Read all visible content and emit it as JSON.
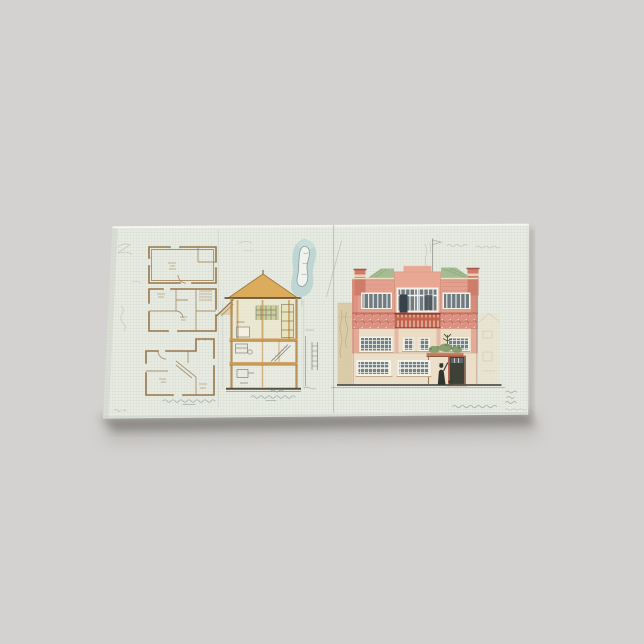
{
  "product": {
    "kind": "stretched canvas print",
    "orientation": "landscape"
  },
  "artwork": {
    "medium": "hand-drawn architectural sheet",
    "panels": [
      {
        "name": "floor-plans",
        "drawings": 3
      },
      {
        "name": "cross-section",
        "drawings": 1
      },
      {
        "name": "front-elevation",
        "drawings": 1
      }
    ],
    "details": [
      "blue-sculpture-sketch",
      "flagpole",
      "street-figure",
      "illegible-handwritten-captions"
    ]
  },
  "palette": {
    "scene": {
      "background": "#d4d2d0",
      "shadow": "#6b6864"
    },
    "canvas": {
      "paper": "#e8ebe2",
      "top_highlight": "#f4f6f0",
      "left_shade": "#cbd0c5"
    },
    "plan": {
      "ink": "#97764a",
      "ink_light": "#ab8d60"
    },
    "section": {
      "roof": "#dcab5b",
      "wood": "#c89a56",
      "wall": "#b28c50",
      "wash": "#ece7cc",
      "olive": "#c2c78c",
      "base_line": "#57503f",
      "detail": "#77736a"
    },
    "blob": {
      "blue": "#b7d2d2",
      "figure": "#f2f4ef",
      "outline": "#8c9896"
    },
    "elevation": {
      "salmon": "#e4a08f",
      "brick_red": "#bf5b4a",
      "frieze": "#db9182",
      "cream": "#efe8d6",
      "floor_cream": "#eadcc5",
      "roof_green": "#a5bb92",
      "chimney": "#cf7c68",
      "glass": "#6e7b83",
      "frame": "#f4f1e6",
      "dark_window": "#38424b",
      "door": "#3d4136",
      "porch_roof": "#c07a5e",
      "plant": "#7e9b68",
      "figure": "#32352d",
      "ground": "#55524a",
      "neighbor_tan": "#d8c79f",
      "neighbor_cream": "#eae0c8"
    },
    "pencil": "#9fa69d",
    "caption": "#94a09a"
  }
}
